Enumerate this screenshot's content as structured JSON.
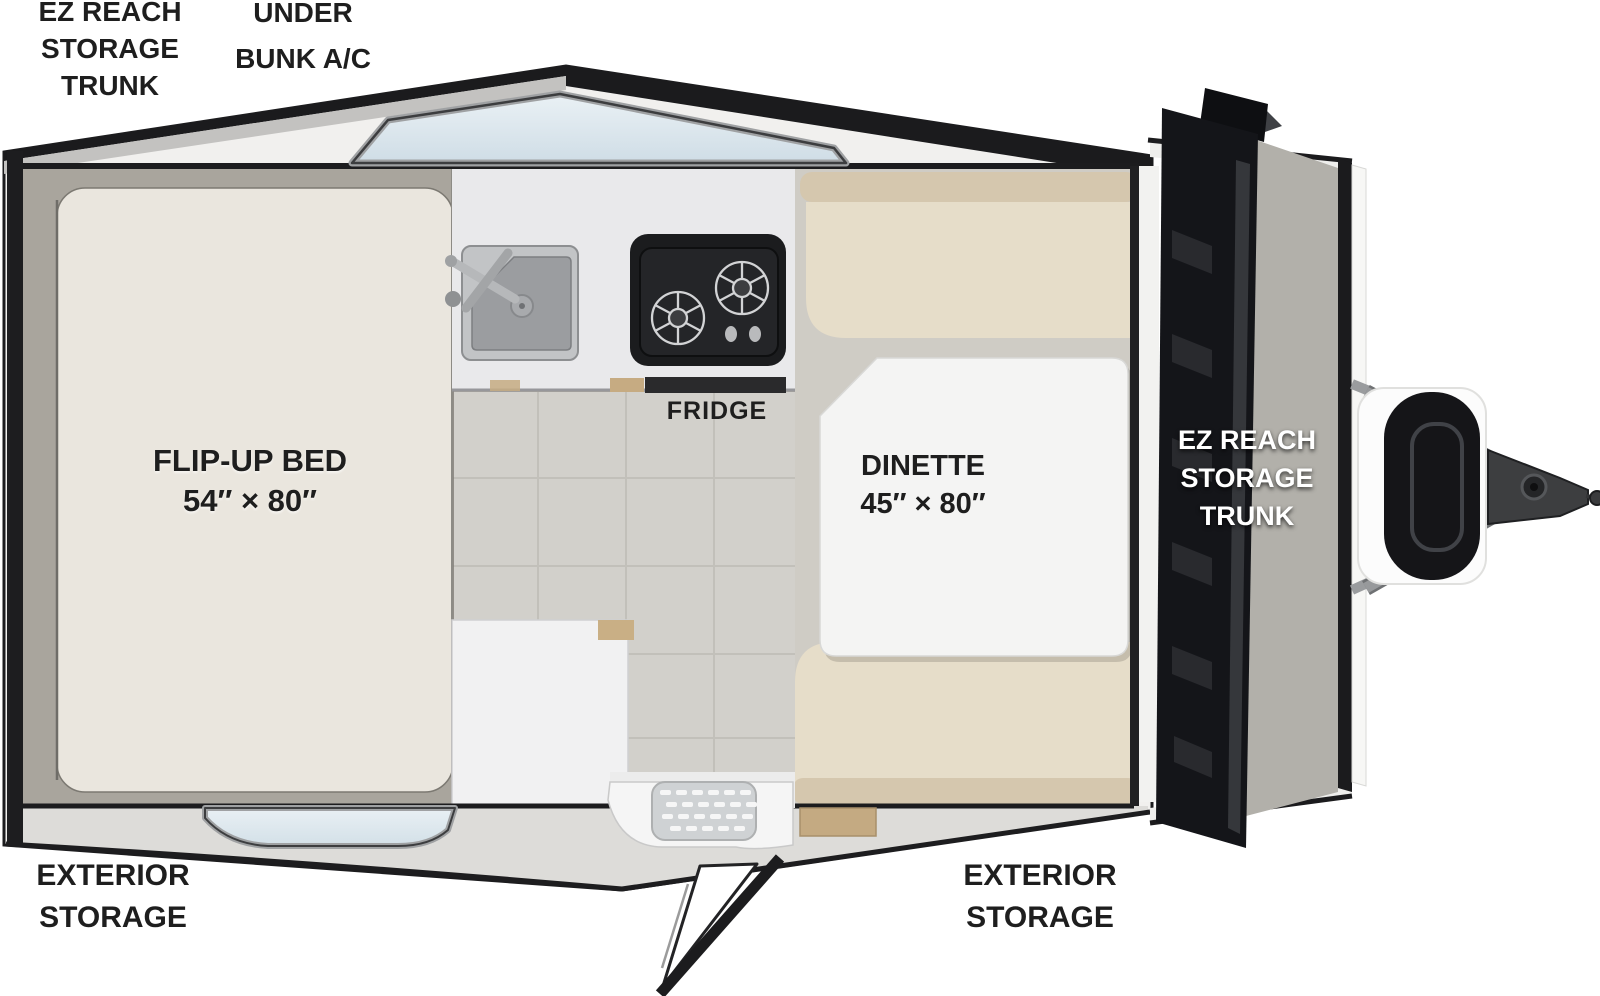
{
  "title": "A-frame camper floorplan",
  "floorplan": {
    "exterior_labels": {
      "rear_trunk": {
        "lines": [
          "EZ REACH",
          "STORAGE",
          "TRUNK"
        ]
      },
      "under_bunk_ac": {
        "lines": [
          "UNDER",
          "BUNK A/C"
        ]
      },
      "exterior_storage_left": {
        "lines": [
          "EXTERIOR",
          "STORAGE"
        ]
      },
      "exterior_storage_right": {
        "lines": [
          "EXTERIOR",
          "STORAGE"
        ]
      }
    },
    "interior_labels": {
      "bed": {
        "name": "FLIP-UP BED",
        "dimensions": "54″ × 80″"
      },
      "dinette": {
        "name": "DINETTE",
        "dimensions": "45″ × 80″"
      },
      "fridge": "FRIDGE",
      "front_trunk": {
        "lines": [
          "EZ REACH",
          "STORAGE",
          "TRUNK"
        ]
      }
    },
    "fixtures": [
      "flip-up-bed",
      "kitchen-sink",
      "two-burner-stove",
      "fridge",
      "dinette-table",
      "dinette-bench-upper",
      "dinette-bench-lower",
      "entry-door",
      "entry-step",
      "roof-window-rear",
      "roof-window-door-side",
      "ez-reach-storage-trunk-door",
      "propane-tank",
      "a-frame-tongue",
      "hitch-coupler"
    ],
    "colors": {
      "outline_black": "#1c1c1e",
      "roof_white": "#f1f0ee",
      "roof_gray_band": "#c3c2c0",
      "wall_gap_gray": "#a9a59d",
      "bed_cream": "#eae6de",
      "counter_white": "#e9e9eb",
      "floor_tile": "#d2d0cb",
      "cushion_seat": "#e6ddc9",
      "cushion_backrest": "#d5c7ae",
      "table_white": "#f4f4f3",
      "trunk_door_black": "#141519",
      "propane_black": "#151518",
      "window_glass": "#dde9ef",
      "wood_trim": "#c6ab82"
    }
  }
}
